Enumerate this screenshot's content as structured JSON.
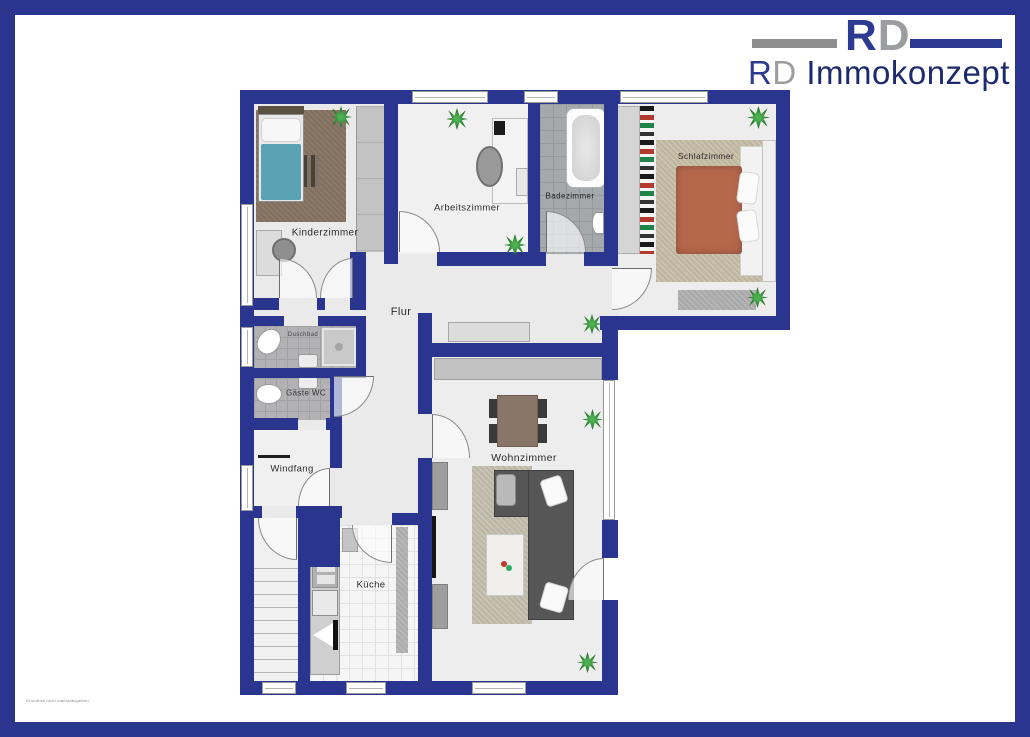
{
  "page": {
    "watermark": "Grundriss nicht maßstabsgetreu"
  },
  "logo": {
    "mark_r": "R",
    "mark_d": "D",
    "name_r": "R",
    "name_d": "D",
    "name_rest": " Immokonzept"
  },
  "rooms": {
    "kinderzimmer": {
      "label": "Kinderzimmer"
    },
    "arbeitszimmer": {
      "label": "Arbeitszimmer"
    },
    "badezimmer": {
      "label": "Badezimmer"
    },
    "schlafzimmer": {
      "label": "Schlafzimmer"
    },
    "flur": {
      "label": "Flur"
    },
    "duschbad": {
      "label": "Duschbad"
    },
    "gaeste_wc": {
      "label": "Gäste WC"
    },
    "windfang": {
      "label": "Windfang"
    },
    "kueche": {
      "label": "Küche"
    },
    "wohnzimmer": {
      "label": "Wohnzimmer"
    }
  },
  "colors": {
    "wall": "#2A3590",
    "logo_blue": "#2D3A92",
    "logo_gray": "#9B9DA0",
    "logo_navy": "#1E2A6E",
    "floor": "#EAEAEA",
    "tile_dark": "#A6A9AB",
    "bed_teal": "#5AA3B5",
    "duvet_terracotta": "#B5674C",
    "sofa_gray": "#555555",
    "plant_green": "#2F7D32"
  }
}
